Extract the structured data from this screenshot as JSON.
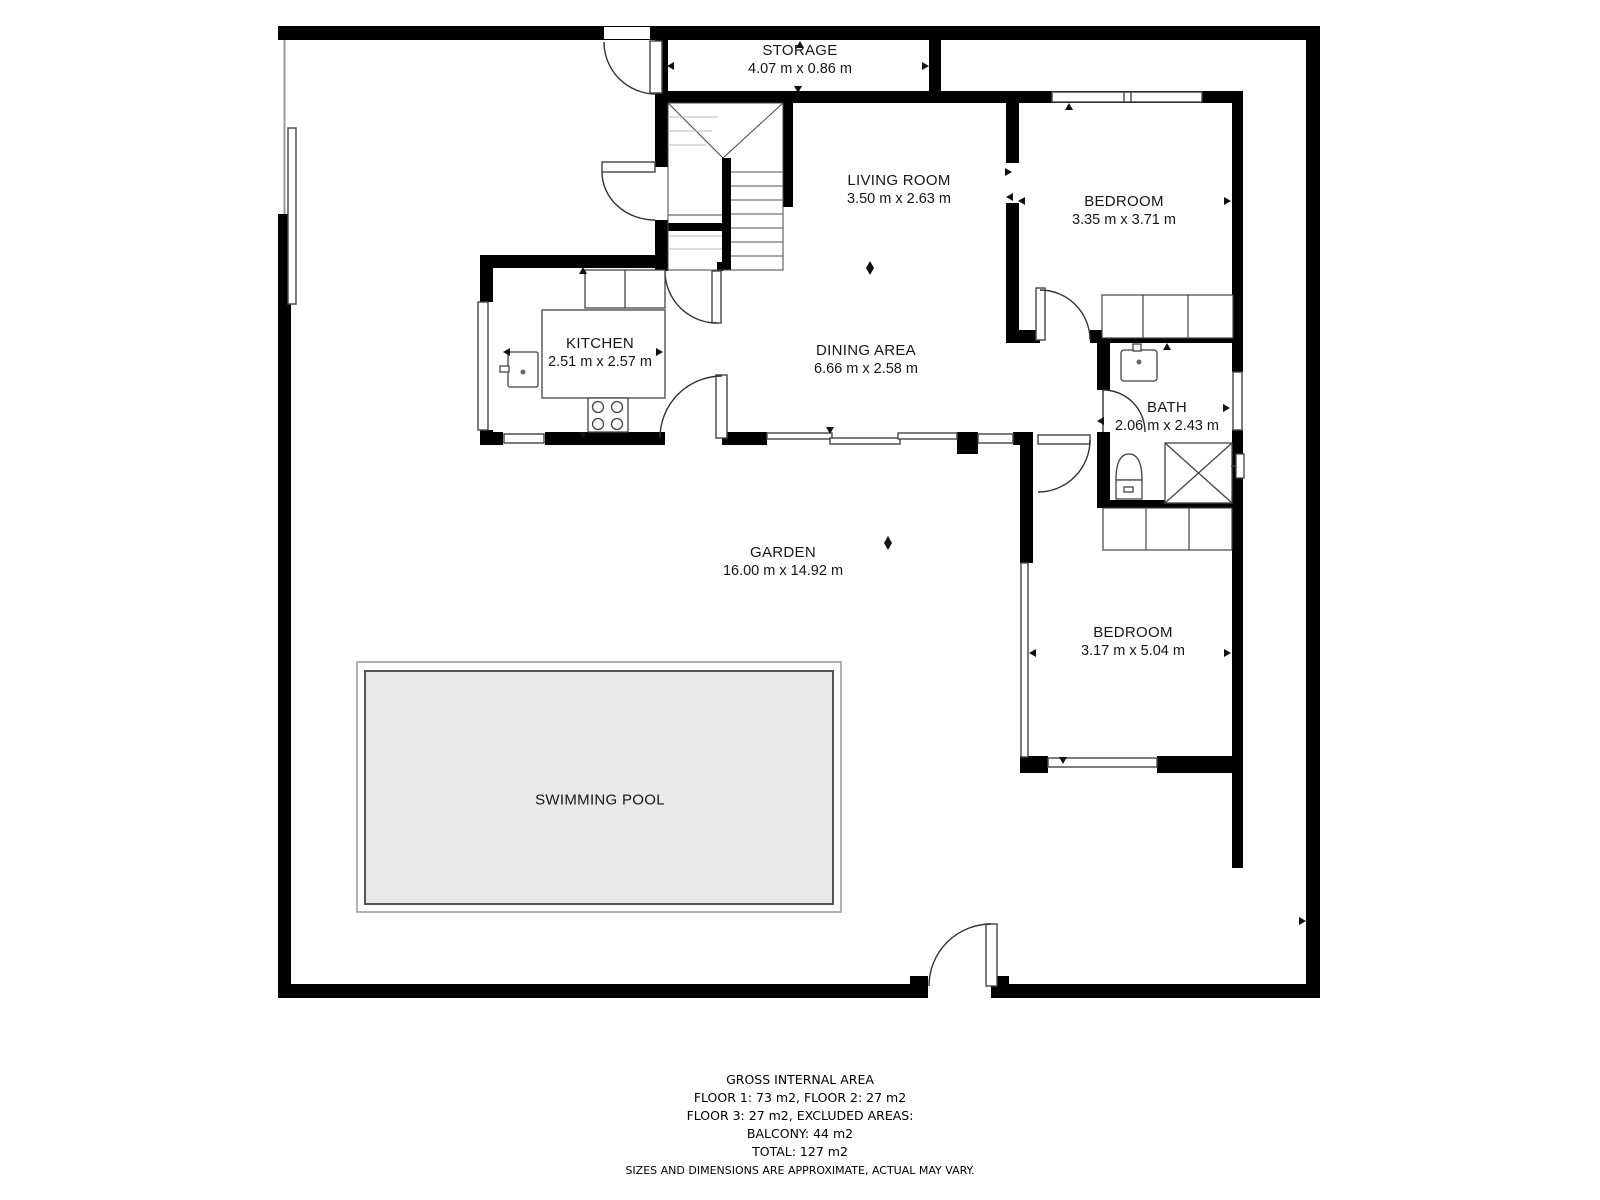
{
  "rooms": [
    {
      "name": "STORAGE",
      "dims": "4.07 m x 0.86 m"
    },
    {
      "name": "LIVING ROOM",
      "dims": "3.50 m x 2.63 m"
    },
    {
      "name": "BEDROOM",
      "dims": "3.35 m x 3.71 m"
    },
    {
      "name": "KITCHEN",
      "dims": "2.51 m x 2.57 m"
    },
    {
      "name": "DINING AREA",
      "dims": "6.66 m x 2.58 m"
    },
    {
      "name": "BATH",
      "dims": "2.06 m x 2.43 m"
    },
    {
      "name": "GARDEN",
      "dims": "16.00 m x 14.92 m"
    },
    {
      "name": "BEDROOM",
      "dims": "3.17 m x 5.04 m"
    },
    {
      "name": "SWIMMING POOL",
      "dims": ""
    }
  ],
  "footer": {
    "lines": [
      "GROSS INTERNAL AREA",
      "FLOOR 1: 73 m2, FLOOR 2: 27 m2",
      "FLOOR 3: 27 m2, EXCLUDED AREAS:",
      "BALCONY: 44 m2",
      "TOTAL: 127 m2",
      "SIZES AND DIMENSIONS ARE APPROXIMATE, ACTUAL MAY VARY."
    ]
  },
  "colors": {
    "wall": "#000000",
    "background": "#ffffff",
    "pool_fill": "#e9e9e9",
    "pool_border": "#555555",
    "pool_outline": "#999999",
    "fixture_line": "#444444",
    "door_arc": "#333333"
  },
  "icons": {
    "dimension_arrow": "small solid triangle marking measured extent",
    "door_swing": "quarter-circle arc",
    "shower": "rectangle with X diagonals",
    "stove": "rectangle with four burner circles"
  }
}
